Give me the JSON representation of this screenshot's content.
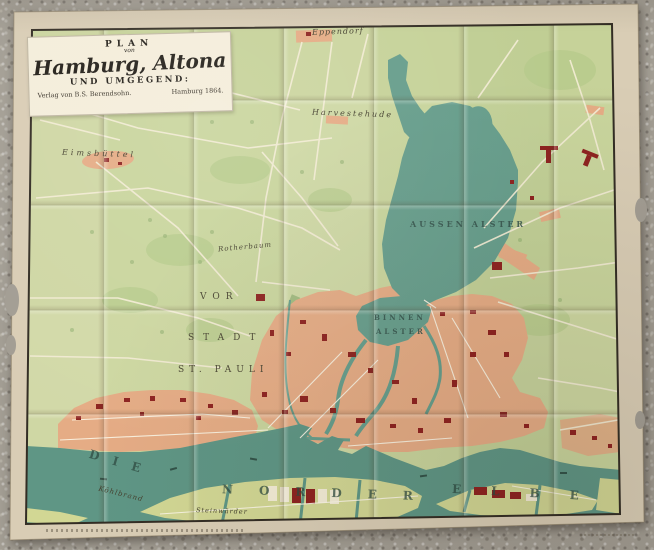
{
  "palette": {
    "stone": "#a29d93",
    "paper": "#d9cdb5",
    "map_green": "#c9d59d",
    "park_green": "#b3c989",
    "water": "#679e8c",
    "built": "#e5ac85",
    "building_red": "#8e2320",
    "street_cream": "#f2ebd3",
    "frame_black": "#332d24"
  },
  "cartouche": {
    "plan": "PLAN",
    "von": "von",
    "title": "Hamburg, Altona",
    "subtitle": "UND UMGEGEND:",
    "publisher": "Verlag von B.S. Berendsohn.",
    "edition": "Hamburg 1864."
  },
  "labels": {
    "eppendorf": "Eppendorf",
    "harvestehude": "Harvestehude",
    "eimsbuettel": "Eimsbüttel",
    "rotherbaum": "Rotherbaum",
    "aussen_alster": "AUSSEN  ALSTER",
    "binnen": "BINNEN",
    "alster": "ALSTER",
    "vor": "VOR",
    "stadt": "STADT",
    "st_pauli": "ST. PAULI",
    "die": "DIE",
    "norder": "NORDER",
    "elbe": "ELBE",
    "koehlbrand": "Köhlbrand",
    "steinwaerder": "Steinwärder"
  }
}
